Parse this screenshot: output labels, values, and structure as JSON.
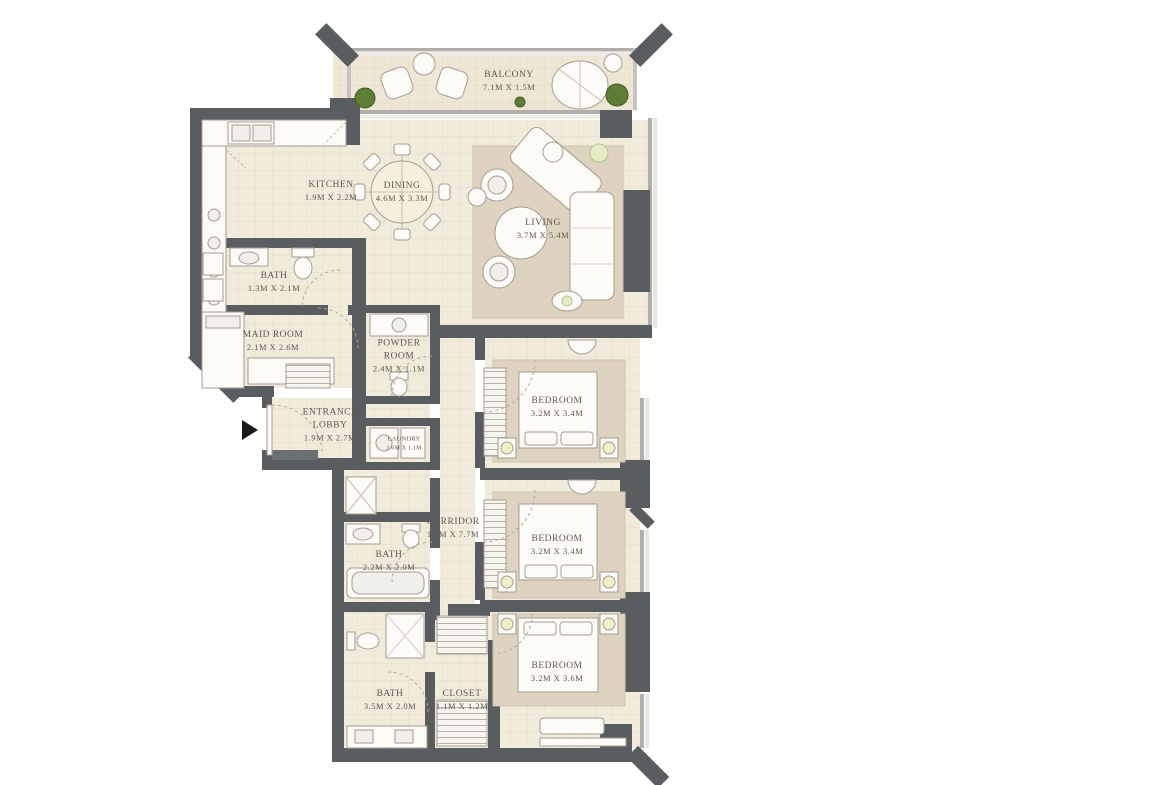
{
  "plan": {
    "type": "apartment-floor-plan",
    "rooms": 16
  },
  "rooms": {
    "balcony": {
      "name": "BALCONY",
      "dims": "7.1M X 1.5M"
    },
    "kitchen": {
      "name": "KITCHEN",
      "dims": "1.9M X 2.2M"
    },
    "dining": {
      "name": "DINING",
      "dims": "4.6M X 3.3M"
    },
    "living": {
      "name": "LIVING",
      "dims": "3.7M X 5.4M"
    },
    "bath_maid": {
      "name": "BATH",
      "dims": "1.3M X 2.1M"
    },
    "maid_room": {
      "name": "MAID ROOM",
      "dims": "2.1M X 2.6M"
    },
    "powder_room": {
      "name": "POWDER ROOM",
      "dims": "2.4M X 1.1M"
    },
    "entrance_lobby": {
      "name": "ENTRANCE LOBBY",
      "dims": "1.9M X 2.7M"
    },
    "laundry": {
      "name": "LAUNDRY",
      "dims": "1.6M X 1.1M"
    },
    "corridor": {
      "name": "CORRIDOR",
      "dims": "1.1M X 7.7M"
    },
    "bath_2": {
      "name": "BATH",
      "dims": "2.2M X 2.0M"
    },
    "bedroom_1": {
      "name": "BEDROOM",
      "dims": "3.2M X 3.4M"
    },
    "bedroom_2": {
      "name": "BEDROOM",
      "dims": "3.2M X 3.4M"
    },
    "bedroom_3": {
      "name": "BEDROOM",
      "dims": "3.2M X 3.6M"
    },
    "bath_3": {
      "name": "BATH",
      "dims": "3.5M X 2.0M"
    },
    "closet": {
      "name": "CLOSET",
      "dims": "1.1M X 1.2M"
    }
  },
  "colors": {
    "wall": "#595d60",
    "floor": "#f1ebdc",
    "floor_line": "#e4ddcb",
    "rug": "#ded3c0",
    "furniture_fill": "#fcfbf8",
    "furniture_stroke": "#a49d90",
    "plant": "#5f7d36",
    "label_text": "#5f574c",
    "window": "#b0aeaa",
    "entrance_marker": "#1a1a1a"
  },
  "icons": {
    "entrance": "entrance-arrow-icon",
    "plants": "plant-icon",
    "doors": "door-swing-arc"
  }
}
